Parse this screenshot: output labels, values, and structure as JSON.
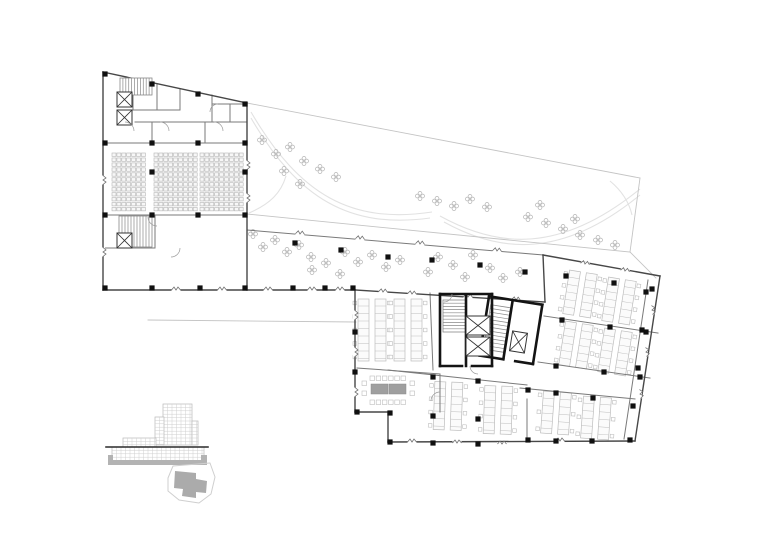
{
  "canvas": {
    "width": 780,
    "height": 552,
    "background": "#ffffff"
  },
  "colors": {
    "wall_dark": "#474747",
    "wall_medium": "#7a7a7a",
    "wall_light": "#c4c4c4",
    "column_fill": "#101010",
    "core_wall": "#141414",
    "plant_stroke": "#b4b4b4",
    "furniture_stroke": "#bdbdbd",
    "seat_stroke": "#b5b5b5",
    "path_curve": "#e2e2e2",
    "door_arc": "#9a9a9a",
    "break_glyph": "#6f6f6f",
    "table_fill": "#9f9f9f",
    "elevation_grid": "#cfcfcf",
    "elevation_outline": "#b9b9b9",
    "level_line": "#2a2a2a",
    "poche_fill": "#b3b3b3",
    "site_outline": "#cfcfcf",
    "site_footprint": "#ababab"
  },
  "plan": {
    "walls_dark": [
      [
        103,
        72,
        247,
        103
      ],
      [
        103,
        72,
        103,
        290
      ],
      [
        103,
        290,
        355,
        290
      ],
      [
        247,
        103,
        247,
        290
      ],
      [
        355,
        290,
        545,
        302
      ],
      [
        545,
        302,
        543,
        255
      ],
      [
        543,
        255,
        660,
        276
      ],
      [
        660,
        276,
        635,
        441
      ],
      [
        635,
        441,
        388,
        442
      ],
      [
        388,
        442,
        388,
        412
      ],
      [
        388,
        412,
        355,
        412
      ],
      [
        355,
        412,
        355,
        290
      ]
    ],
    "walls_medium": [
      [
        135,
        122,
        247,
        122
      ],
      [
        103,
        143,
        247,
        143
      ],
      [
        152,
        122,
        152,
        143
      ],
      [
        205,
        122,
        205,
        143
      ],
      [
        133,
        79,
        133,
        110
      ],
      [
        157,
        84,
        157,
        110
      ],
      [
        180,
        89,
        180,
        110
      ],
      [
        133,
        110,
        180,
        110
      ],
      [
        212,
        95,
        212,
        122
      ],
      [
        212,
        104,
        247,
        104
      ],
      [
        230,
        104,
        230,
        122
      ],
      [
        103,
        215,
        247,
        215
      ],
      [
        155,
        215,
        155,
        248
      ],
      [
        103,
        248,
        155,
        248
      ],
      [
        247,
        230,
        543,
        255
      ],
      [
        544,
        316,
        658,
        333
      ],
      [
        538,
        362,
        650,
        378
      ],
      [
        520,
        388,
        635,
        399
      ],
      [
        527,
        399,
        527,
        441
      ],
      [
        388,
        370,
        527,
        385
      ],
      [
        430,
        293,
        433,
        370
      ],
      [
        357,
        368,
        440,
        374
      ],
      [
        440,
        374,
        440,
        412
      ],
      [
        648,
        280,
        624,
        439
      ]
    ],
    "walls_light": [
      [
        247,
        103,
        640,
        178
      ],
      [
        640,
        178,
        630,
        252
      ],
      [
        630,
        252,
        247,
        214
      ],
      [
        630,
        252,
        656,
        278
      ],
      [
        148,
        320,
        356,
        322
      ]
    ],
    "columns": [
      [
        105,
        74
      ],
      [
        152,
        84
      ],
      [
        198,
        94
      ],
      [
        245,
        104
      ],
      [
        105,
        143
      ],
      [
        105,
        215
      ],
      [
        105,
        288
      ],
      [
        152,
        143
      ],
      [
        198,
        143
      ],
      [
        245,
        143
      ],
      [
        152,
        215
      ],
      [
        198,
        215
      ],
      [
        245,
        215
      ],
      [
        152,
        172
      ],
      [
        245,
        172
      ],
      [
        152,
        288
      ],
      [
        200,
        288
      ],
      [
        245,
        288
      ],
      [
        293,
        288
      ],
      [
        325,
        288
      ],
      [
        353,
        288
      ],
      [
        295,
        243
      ],
      [
        341,
        250
      ],
      [
        388,
        257
      ],
      [
        432,
        260
      ],
      [
        480,
        265
      ],
      [
        525,
        272
      ],
      [
        566,
        276
      ],
      [
        614,
        283
      ],
      [
        652,
        289
      ],
      [
        562,
        320
      ],
      [
        610,
        327
      ],
      [
        646,
        332
      ],
      [
        556,
        366
      ],
      [
        604,
        372
      ],
      [
        640,
        377
      ],
      [
        528,
        390
      ],
      [
        556,
        393
      ],
      [
        593,
        398
      ],
      [
        528,
        440
      ],
      [
        556,
        441
      ],
      [
        592,
        441
      ],
      [
        630,
        440
      ],
      [
        646,
        292
      ],
      [
        642,
        330
      ],
      [
        638,
        368
      ],
      [
        633,
        406
      ],
      [
        357,
        412
      ],
      [
        390,
        413
      ],
      [
        433,
        416
      ],
      [
        478,
        419
      ],
      [
        390,
        442
      ],
      [
        433,
        443
      ],
      [
        478,
        444
      ],
      [
        433,
        377
      ],
      [
        478,
        381
      ],
      [
        355,
        332
      ],
      [
        355,
        372
      ]
    ],
    "plants": [
      [
        262,
        140
      ],
      [
        276,
        154
      ],
      [
        290,
        147
      ],
      [
        304,
        161
      ],
      [
        320,
        169
      ],
      [
        336,
        177
      ],
      [
        300,
        184
      ],
      [
        284,
        171
      ],
      [
        420,
        196
      ],
      [
        437,
        201
      ],
      [
        454,
        206
      ],
      [
        470,
        199
      ],
      [
        487,
        207
      ],
      [
        528,
        217
      ],
      [
        546,
        223
      ],
      [
        563,
        229
      ],
      [
        580,
        235
      ],
      [
        598,
        240
      ],
      [
        615,
        245
      ],
      [
        575,
        219
      ],
      [
        540,
        205
      ],
      [
        253,
        234
      ],
      [
        263,
        247
      ],
      [
        275,
        240
      ],
      [
        287,
        252
      ],
      [
        299,
        245
      ],
      [
        311,
        257
      ],
      [
        326,
        263
      ],
      [
        340,
        274
      ],
      [
        345,
        252
      ],
      [
        358,
        262
      ],
      [
        372,
        255
      ],
      [
        386,
        267
      ],
      [
        400,
        260
      ],
      [
        312,
        270
      ],
      [
        438,
        257
      ],
      [
        453,
        265
      ],
      [
        473,
        255
      ],
      [
        490,
        268
      ],
      [
        503,
        278
      ],
      [
        520,
        272
      ],
      [
        465,
        277
      ],
      [
        428,
        272
      ]
    ],
    "window_breaks": [
      [
        176,
        290,
        0
      ],
      [
        222,
        290,
        0
      ],
      [
        268,
        290,
        0
      ],
      [
        312,
        290,
        0
      ],
      [
        340,
        290,
        0
      ],
      [
        300,
        234,
        5
      ],
      [
        360,
        239,
        5
      ],
      [
        420,
        244,
        5
      ],
      [
        497,
        251,
        5
      ],
      [
        383,
        292,
        4
      ],
      [
        412,
        294,
        4
      ],
      [
        468,
        297,
        4
      ],
      [
        516,
        300,
        4
      ],
      [
        585,
        264,
        10
      ],
      [
        625,
        271,
        10
      ],
      [
        652,
        310,
        83
      ],
      [
        646,
        352,
        83
      ],
      [
        640,
        394,
        83
      ],
      [
        412,
        442,
        0
      ],
      [
        457,
        443,
        0
      ],
      [
        502,
        444,
        0
      ],
      [
        560,
        441,
        0
      ],
      [
        355,
        315,
        90
      ],
      [
        355,
        352,
        90
      ],
      [
        355,
        392,
        90
      ],
      [
        247,
        165,
        90
      ],
      [
        247,
        198,
        90
      ],
      [
        103,
        180,
        90
      ],
      [
        103,
        252,
        90
      ]
    ],
    "desk_clusters": [
      [
        580,
        294,
        9,
        30,
        44
      ],
      [
        619,
        301,
        9,
        30,
        44
      ],
      [
        576,
        345,
        9,
        30,
        44
      ],
      [
        615,
        352,
        9,
        30,
        44
      ],
      [
        556,
        413,
        4,
        30,
        42
      ],
      [
        596,
        418,
        4,
        30,
        42
      ],
      [
        448,
        406,
        2,
        26,
        48
      ],
      [
        498,
        410,
        2,
        26,
        48
      ],
      [
        372,
        330,
        0,
        26,
        62
      ],
      [
        408,
        330,
        0,
        26,
        62
      ]
    ],
    "auditorium_seating": [
      {
        "x0": 112,
        "y0": 153,
        "cols": 7,
        "rows": 12,
        "dx": 4.9,
        "dy": 4.95,
        "w": 4,
        "h": 3.4
      },
      {
        "x0": 154,
        "y0": 153,
        "cols": 9,
        "rows": 12,
        "dx": 4.9,
        "dy": 4.95,
        "w": 4,
        "h": 3.4
      },
      {
        "x0": 200,
        "y0": 153,
        "cols": 9,
        "rows": 12,
        "dx": 4.9,
        "dy": 4.95,
        "w": 4,
        "h": 3.4
      }
    ],
    "stairs": [
      {
        "x": 120,
        "y": 78,
        "w": 32,
        "h": 17,
        "dir": "v",
        "n": 11,
        "rot": 0,
        "cx": 0,
        "cy": 0
      },
      {
        "x": 119,
        "y": 216,
        "w": 33,
        "h": 31,
        "dir": "v",
        "n": 11,
        "rot": 0,
        "cx": 0,
        "cy": 0
      },
      {
        "x": 443,
        "y": 300,
        "w": 23,
        "h": 32,
        "dir": "h",
        "n": 10,
        "rot": 0,
        "cx": 0,
        "cy": 0
      },
      {
        "x": 487,
        "y": 308,
        "w": 20,
        "h": 45,
        "dir": "h",
        "n": 12,
        "rot": 9,
        "cx": 510,
        "cy": 330
      }
    ],
    "elevators": [
      {
        "x": 117,
        "y": 92,
        "w": 15,
        "h": 15,
        "rot": 0
      },
      {
        "x": 117,
        "y": 110,
        "w": 15,
        "h": 15,
        "rot": 0
      },
      {
        "x": 117,
        "y": 233,
        "w": 15,
        "h": 15,
        "rot": 0
      },
      {
        "x": 466,
        "y": 316,
        "w": 24,
        "h": 19,
        "rot": 0
      },
      {
        "x": 466,
        "y": 337,
        "w": 24,
        "h": 19,
        "rot": 0
      },
      {
        "x": 511,
        "y": 332,
        "w": 15,
        "h": 20,
        "rot": 9
      }
    ],
    "core_walls": [
      {
        "rot": 0,
        "cx": 0,
        "cy": 0,
        "segs": [
          [
            440,
            294,
            492,
            294
          ],
          [
            440,
            294,
            440,
            366
          ],
          [
            492,
            294,
            492,
            366
          ],
          [
            440,
            366,
            462,
            366
          ],
          [
            472,
            366,
            492,
            366
          ],
          [
            466,
            296,
            466,
            366
          ]
        ]
      },
      {
        "rot": 9,
        "cx": 510,
        "cy": 330,
        "segs": [
          [
            484,
            300,
            538,
            300
          ],
          [
            484,
            300,
            484,
            360
          ],
          [
            538,
            300,
            538,
            360
          ],
          [
            484,
            360,
            508,
            360
          ],
          [
            520,
            360,
            538,
            360
          ],
          [
            508,
            302,
            508,
            360
          ]
        ]
      }
    ],
    "door_arcs": [
      "M125,122 A9,9 0 0 1 134,131",
      "M160,122 A9,9 0 0 1 169,131",
      "M214,122 A9,9 0 0 1 223,131",
      "M218,104 A8,8 0 0 0 210,112",
      "M157,226 A9,9 0 0 1 148,217",
      "M180,248 A9,9 0 0 1 171,257",
      "M452,294 A8,8 0 0 1 444,302",
      "M470,366 A8,8 0 0 0 478,374",
      "M440,392 A9,9 0 0 0 431,401"
    ],
    "terrace_paths": [
      "M251,112 C300,196 352,224 432,212",
      "M251,118 C298,199 350,229 430,218",
      "M640,189 C560,254 498,248 440,216",
      "M640,195 C562,259 500,253 444,222",
      "M610,181 C622,191 629,202 632,215",
      "M249,213 C270,204 281,193 286,176"
    ],
    "conference": {
      "tables": [
        [
          371,
          384,
          17,
          10
        ],
        [
          389,
          384,
          17,
          10
        ]
      ],
      "chairs_top": {
        "x0": 370,
        "y": 376,
        "n": 6,
        "dx": 6.2,
        "s": 4.5
      },
      "chairs_bottom": {
        "x0": 370,
        "y": 400,
        "n": 6,
        "dx": 6.2,
        "s": 4.5
      },
      "chairs_left": [
        [
          362,
          381
        ],
        [
          362,
          391
        ]
      ],
      "chairs_right": [
        [
          410,
          381
        ],
        [
          410,
          391
        ]
      ]
    }
  },
  "elevation": {
    "grid_blocks": [
      [
        163,
        404,
        29,
        41
      ],
      [
        155,
        417,
        9,
        28
      ],
      [
        192,
        421,
        6,
        24
      ],
      [
        123,
        438,
        33,
        9
      ],
      [
        112,
        447,
        92,
        14
      ]
    ],
    "grid_step_x": 4.5,
    "grid_step_y": 3.4,
    "level_line": [
      106,
      447,
      208,
      447
    ],
    "poche_path": "M108,455 L113,455 L113,460 L201,460 L201,455 L207,455 L207,465 L108,465 Z"
  },
  "site_key": {
    "outline_path": "M168,478 L173,466 L210,463 L215,477 L211,494 L199,503 L179,500 L168,491 Z",
    "footprint_path": "M175,471 L196,473 L196,479 L207,481 L206,493 L196,492 L196,498 L182,496 L183,489 L174,488 Z"
  }
}
